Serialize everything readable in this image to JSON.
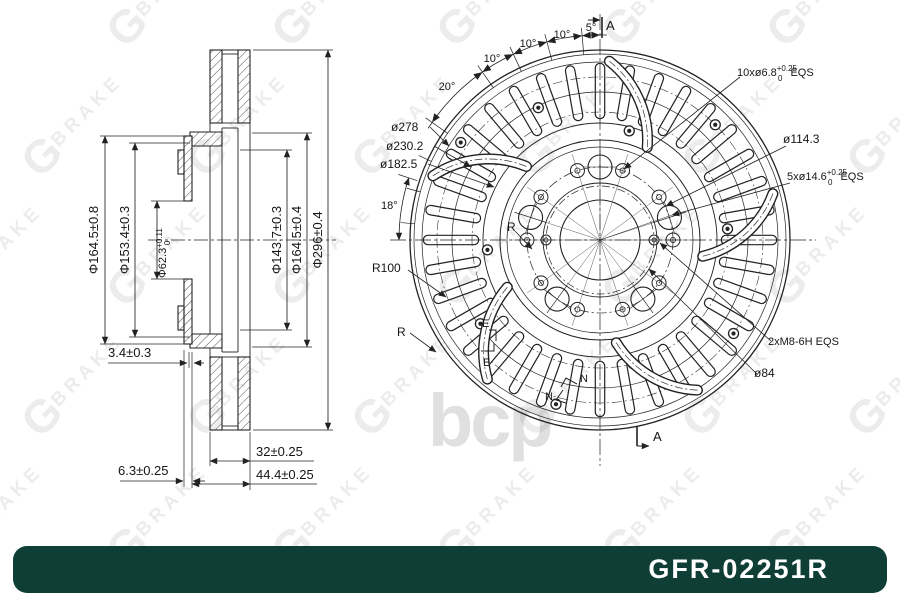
{
  "banner": {
    "part_number": "GFR-02251R",
    "bg_color": "#0e3e36",
    "text_color": "#ffffff"
  },
  "watermark": {
    "brand_g": "G",
    "brand_rest": "BRAKE",
    "bcp": "bcp"
  },
  "left_view": {
    "dims": {
      "flange_od": "Φ164.5±0.8",
      "hat_od": "Φ153.4±0.3",
      "bore_prefix": "Φ62.3",
      "bore_tol_up": "+0.11",
      "bore_tol_dn": "0",
      "hat_id": "Φ143.7±0.3",
      "ring_id": "Φ164.5±0.4",
      "disc_od": "Φ296±0.4",
      "step": "3.4±0.3",
      "ring_thickness": "32±0.25",
      "flange_thickness": "6.3±0.25",
      "overall_height": "44.4±0.25"
    }
  },
  "right_view": {
    "labels": {
      "holes_small_prefix": "10xø6.8",
      "holes_small_tol_up": "+0.25",
      "holes_small_tol_dn": "0",
      "holes_small_suffix": "EQS",
      "pcd": "ø114.3",
      "holes_large_prefix": "5xø14.6",
      "holes_large_tol_up": "+0.25",
      "holes_large_tol_dn": "0",
      "holes_large_suffix": "EQS",
      "service_holes": "2xM8-6H EQS",
      "hub_pcd": "ø84",
      "vent_outer": "ø278",
      "vent_mid": "ø230.2",
      "vent_inner": "ø182.5",
      "angle_5": "5°",
      "angle_10a": "10°",
      "angle_10b": "10°",
      "angle_10c": "10°",
      "angle_20": "20°",
      "angle_18": "18°",
      "vane_radius": "R100",
      "vane_r1": "R",
      "vane_r2": "R",
      "section_a_top": "A",
      "section_a_bottom": "A",
      "section_e1": "E",
      "section_e2": "E",
      "section_n1": "N",
      "section_n2": "N"
    }
  }
}
